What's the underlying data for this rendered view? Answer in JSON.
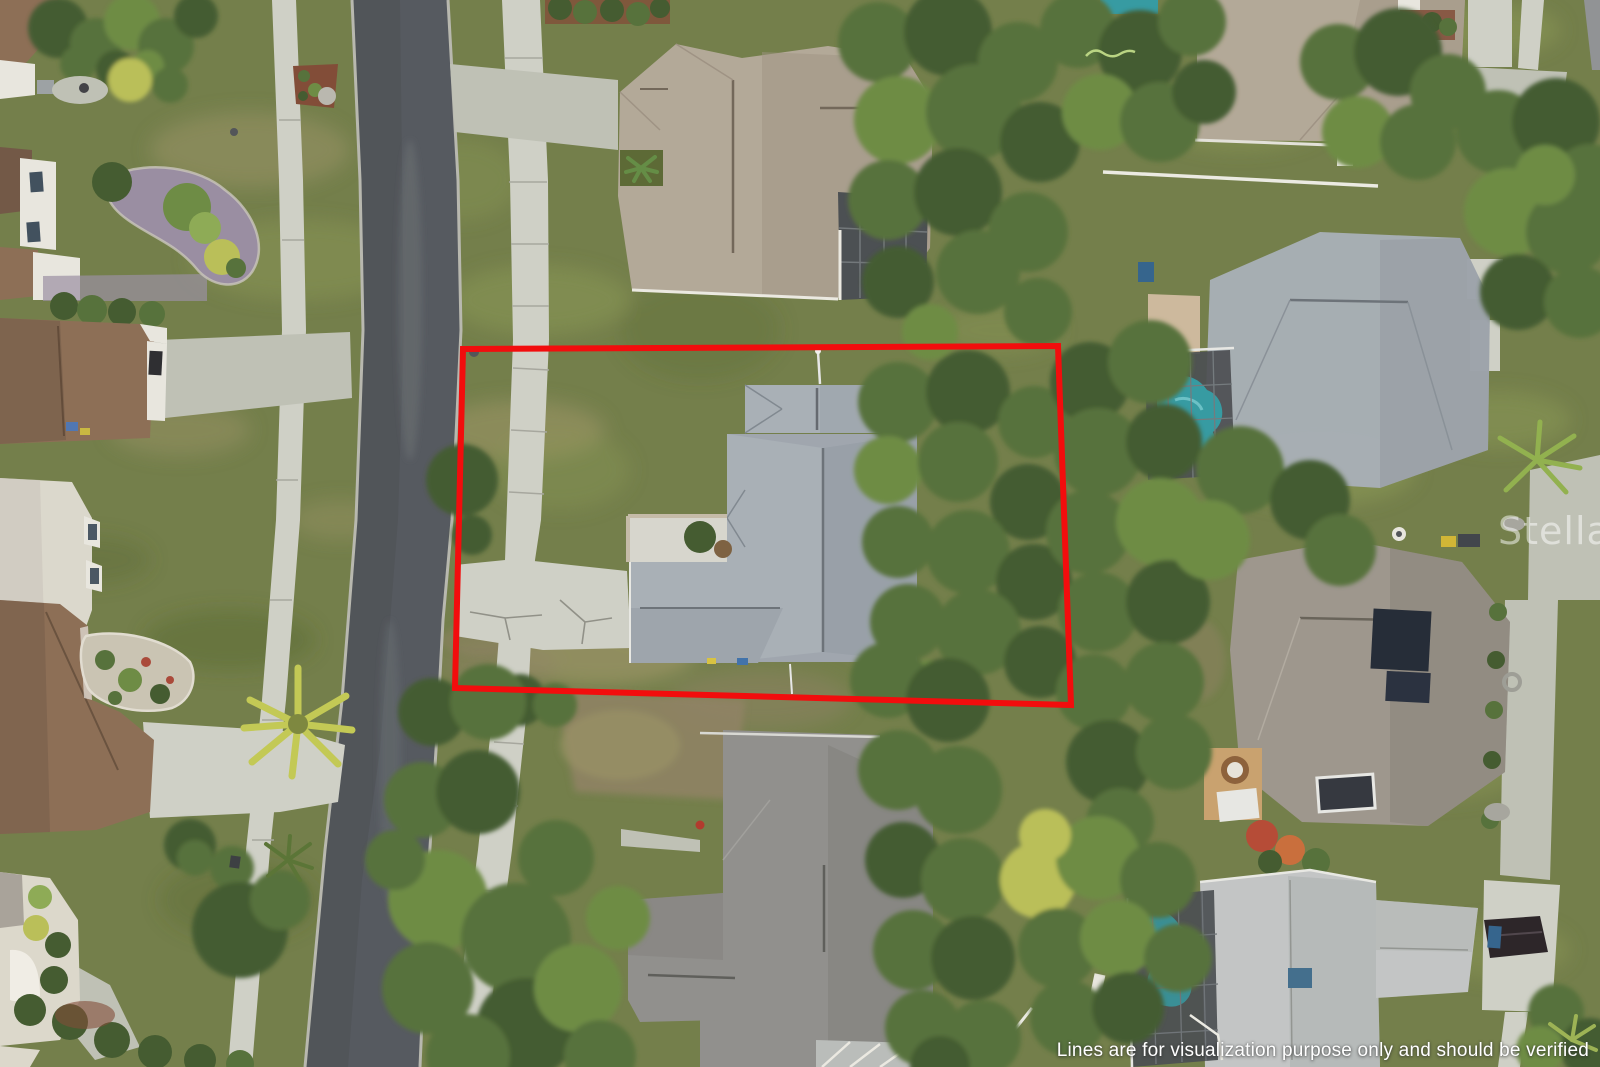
{
  "scene": {
    "type": "aerial-drone-photo",
    "description": "Overhead drone view of a suburban Florida neighborhood; the subject vacant-front lot with a gray-roof house is outlined in red beside a curving street"
  },
  "watermark": {
    "text": "Stellar MLS"
  },
  "disclaimer": {
    "text": "Lines are for visualization purpose only and should be verified"
  },
  "boundary": {
    "points": "463,349 1058,346 1071,705 455,688",
    "color": "#f20d0d",
    "stroke_width": 6
  },
  "palette": {
    "lawn_base": "#6f7b44",
    "lawn_light": "#89954f",
    "lawn_dark": "#57652e",
    "lawn_dry": "#9a9162",
    "dirt": "#8d7f5f",
    "road": "#50545a",
    "road_dark": "#42464c",
    "curb": "#b7b7ad",
    "concrete": "#cfd0c6",
    "concrete_dim": "#bec0b4",
    "roof_subj": "#a7aeb5",
    "roof_subj_dk": "#8f979f",
    "roof_tan": "#b2a795",
    "roof_tan_dk": "#9c9080",
    "roof_gray": "#8e8d89",
    "roof_gray_dk": "#7a7975",
    "roof_lt": "#c2c5c4",
    "roof_lt_dk": "#acafae",
    "roof_brown": "#8a6a50",
    "roof_brown_dk": "#6e5340",
    "white_struct": "#e9e7df",
    "tree_dark": "#3e5629",
    "tree_mid": "#516d34",
    "tree_light": "#69883e",
    "tree_hi": "#8ba950",
    "tree_yel": "#b9be53",
    "screen": "#45494c",
    "pool": "#2f98a0",
    "gravel": "#978ba0",
    "mulch": "#7e4630",
    "boundary": "#f20d0d"
  }
}
